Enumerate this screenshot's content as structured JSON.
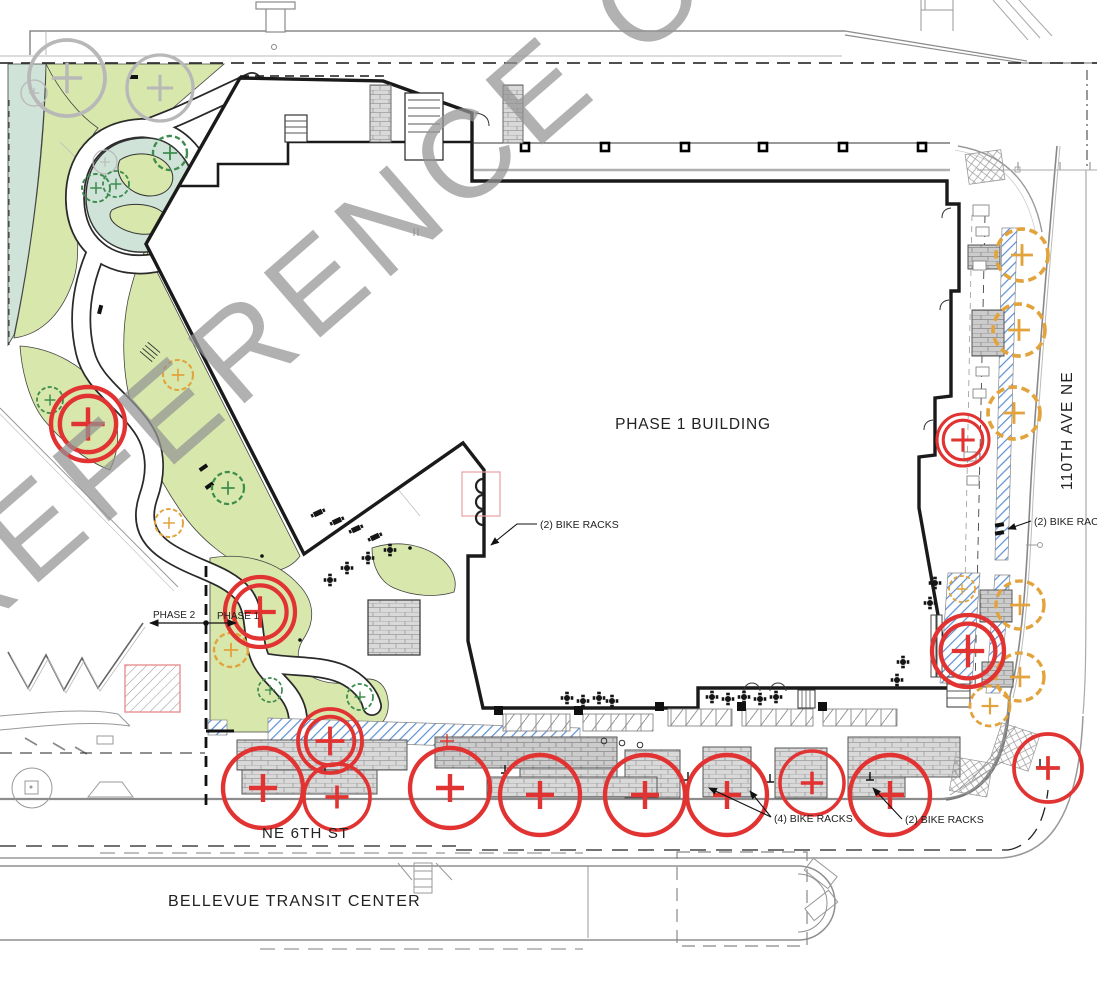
{
  "watermark": {
    "text": "REFERENCE ONLY"
  },
  "building": {
    "label": "PHASE 1 BUILDING"
  },
  "streets": {
    "east": "110TH AVE NE",
    "south": "NE 6TH ST",
    "transit": "BELLEVUE TRANSIT CENTER"
  },
  "phases": {
    "left": "PHASE 2",
    "right": "PHASE 1"
  },
  "callouts": {
    "bike_west": "(2) BIKE RACKS",
    "bike_east": "(2) BIKE RACKS",
    "bike_south_4": "(4) BIKE RACKS",
    "bike_south_2": "(2) BIKE RACKS"
  },
  "colors": {
    "green": "#d8e7ab",
    "teal": "#cfe3d8",
    "paver": "#d9d9d9",
    "paver_dark": "#cccccc",
    "blue_hatch": "#5b8fd4",
    "red": "#e23333",
    "orange": "#e2a33c",
    "tree_green": "#3f8d4e",
    "existing_gray": "#b8b8b8",
    "watermark": "#949494",
    "line": "#1a1a1a"
  }
}
